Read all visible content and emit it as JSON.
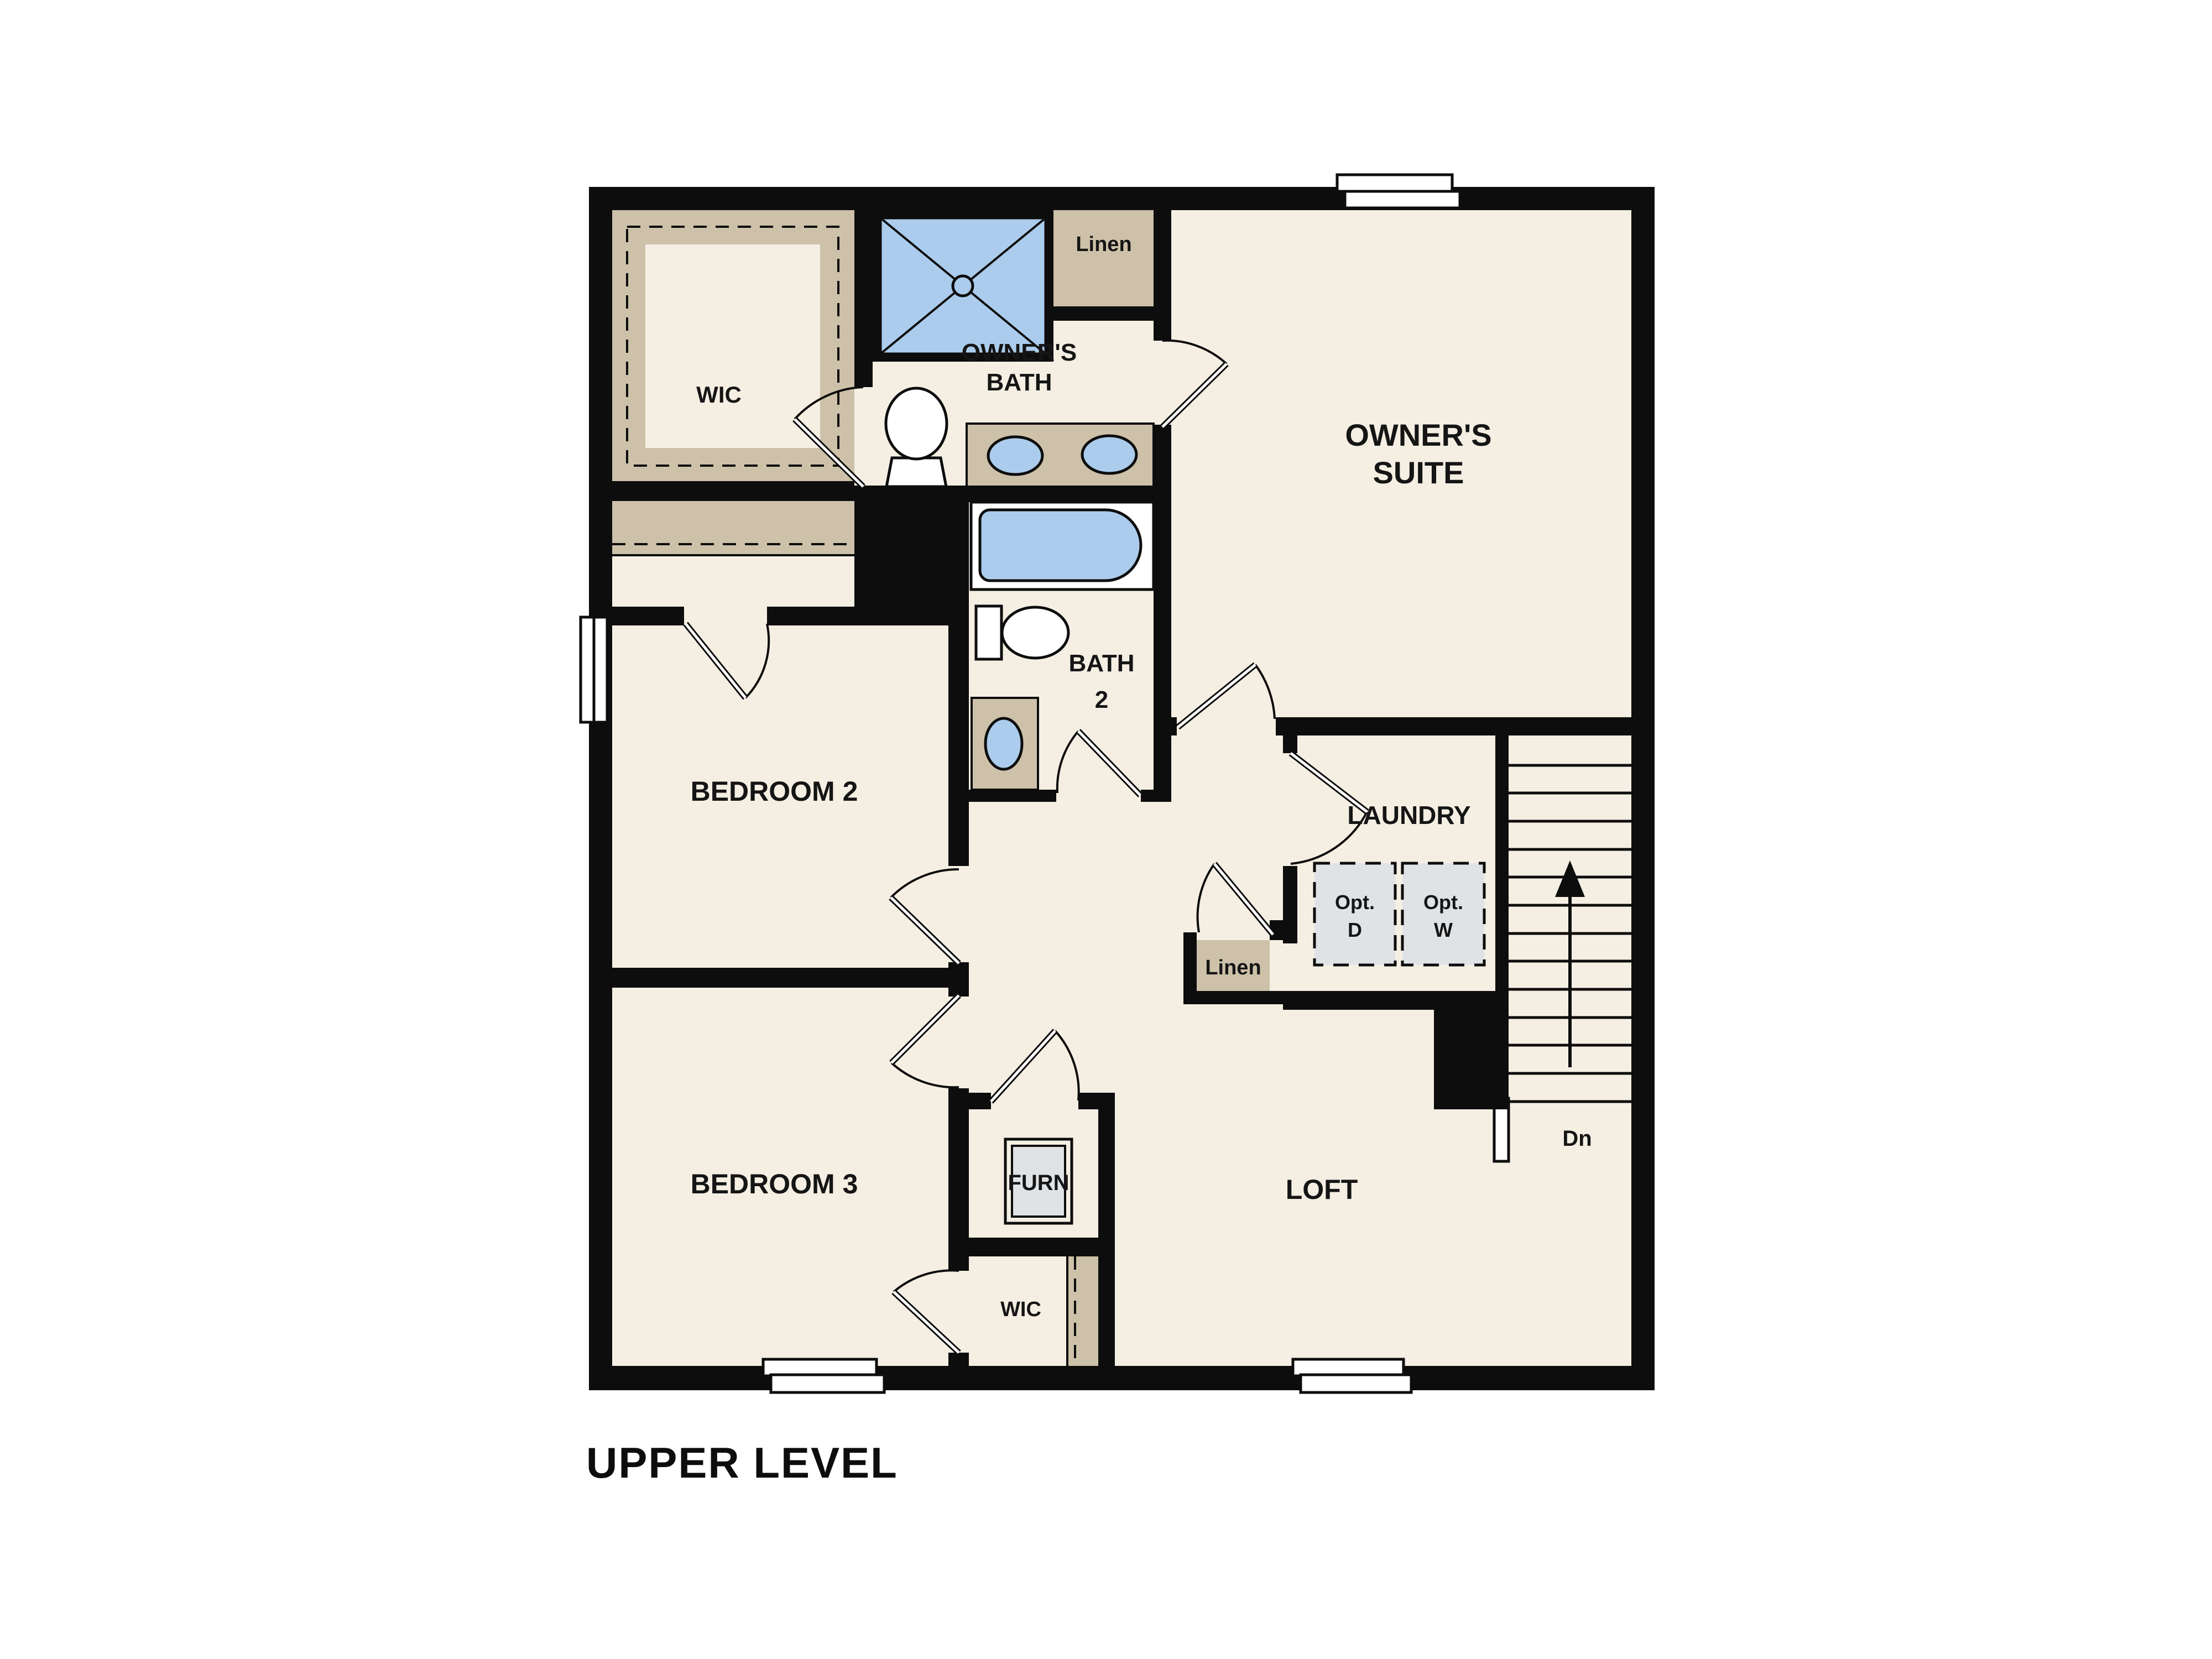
{
  "plan": {
    "title": "UPPER LEVEL"
  },
  "labels": {
    "wic_upper": "WIC",
    "owners_bath_line1": "OWNER'S",
    "owners_bath_line2": "BATH",
    "linen_upper": "Linen",
    "owners_suite_line1": "OWNER'S",
    "owners_suite_line2": "SUITE",
    "bedroom2": "BEDROOM 2",
    "bath2_line1": "BATH",
    "bath2_line2": "2",
    "laundry": "LAUNDRY",
    "opt_dryer_line1": "Opt.",
    "opt_dryer_line2": "D",
    "opt_washer_line1": "Opt.",
    "opt_washer_line2": "W",
    "linen_hall": "Linen",
    "bedroom3": "BEDROOM 3",
    "furnace": "FURN",
    "loft": "LOFT",
    "wic_lower": "WIC",
    "stairs_down": "Dn"
  },
  "colors": {
    "wall": "#0d0d0d",
    "floor": "#f5efe3",
    "closet_tan": "#cdc1a9",
    "fixture_blue": "#abccec",
    "appliance_gray": "#e0e3e6",
    "background": "#ffffff"
  }
}
